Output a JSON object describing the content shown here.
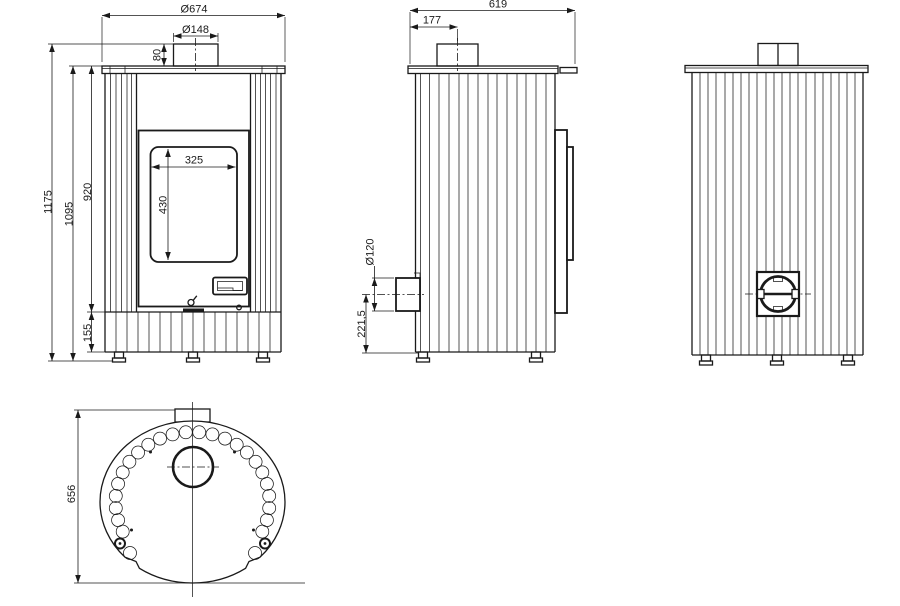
{
  "colors": {
    "background": "#ffffff",
    "line": "#1a1a1a"
  },
  "drawing": {
    "type": "technical-drawing-stove-dimensions",
    "views": {
      "front": {
        "dims": {
          "overall_width": "Ø674",
          "flue_diameter": "Ø148",
          "flue_height": "80",
          "total_height": "1175",
          "body_height": "1095",
          "panel_height": "920",
          "base_height": "155",
          "window_width": "325",
          "window_height": "430"
        }
      },
      "side": {
        "dims": {
          "depth": "619",
          "flue_offset": "177",
          "rear_outlet_diameter": "Ø120",
          "rear_outlet_height": "221,5"
        }
      },
      "top": {
        "dims": {
          "body_depth": "656"
        }
      }
    }
  }
}
